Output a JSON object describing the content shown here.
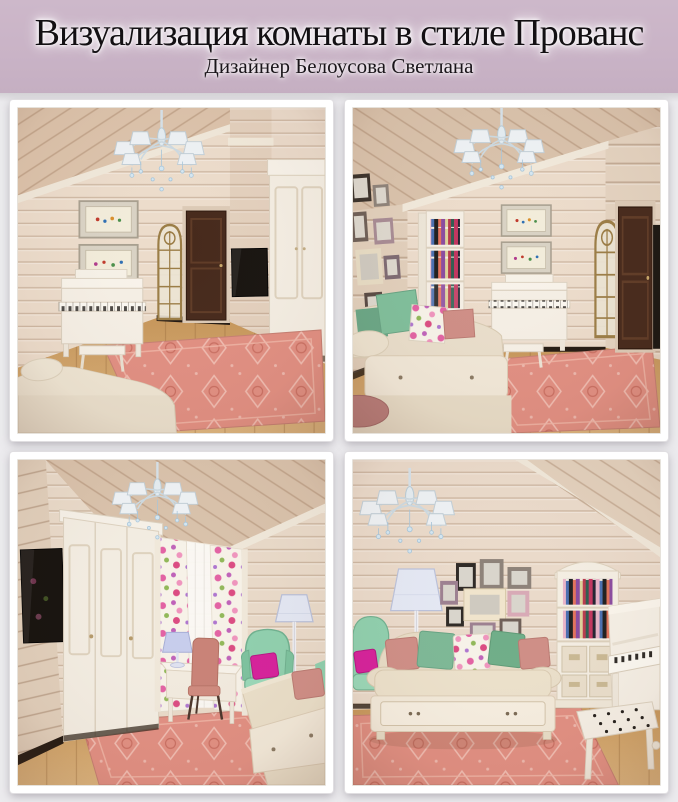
{
  "header": {
    "title": "Визуализация комнаты в стиле Прованс",
    "subtitle": "Дизайнер Белоусова Светлана"
  },
  "gallery": {
    "renders": [
      {
        "position": "top-left",
        "description": "Вид комнаты: белое пианино с банкеткой, картины, арочное зеркало, тёмная дверь, телевизор, белый шкаф, розовый ковёр"
      },
      {
        "position": "top-right",
        "description": "Вид комнаты: диван-кровать с подушками, фоторамки, стеллаж с книгами, белое пианино, арочное зеркало, розовый ковёр"
      },
      {
        "position": "bottom-left",
        "description": "Вид комнаты: телевизор, белый шкаф, цветочные шторы, письменный стол, мятное кресло, торшер, диван-кровать"
      },
      {
        "position": "bottom-right",
        "description": "Вид комнаты: диван-кровать с подушками, коллаж из фоторамок, книжный стеллаж, белое пианино с банкеткой"
      }
    ]
  },
  "palette": {
    "header_background": "#c9b3c6",
    "header_text": "#131013",
    "gallery_background": "#ecebee",
    "photo_frame": "#ffffff",
    "wall_wood": "#eadaca",
    "ceiling_wood": "#dcc3ab",
    "floor_wood": "#d2a66c",
    "rug_coral": "#e18f82",
    "furniture_white": "#f5efe5",
    "door_brown": "#46291b",
    "mint_green": "#8fd0ae",
    "dusty_pink": "#cf8e86",
    "magenta_accent": "#d6219b"
  }
}
